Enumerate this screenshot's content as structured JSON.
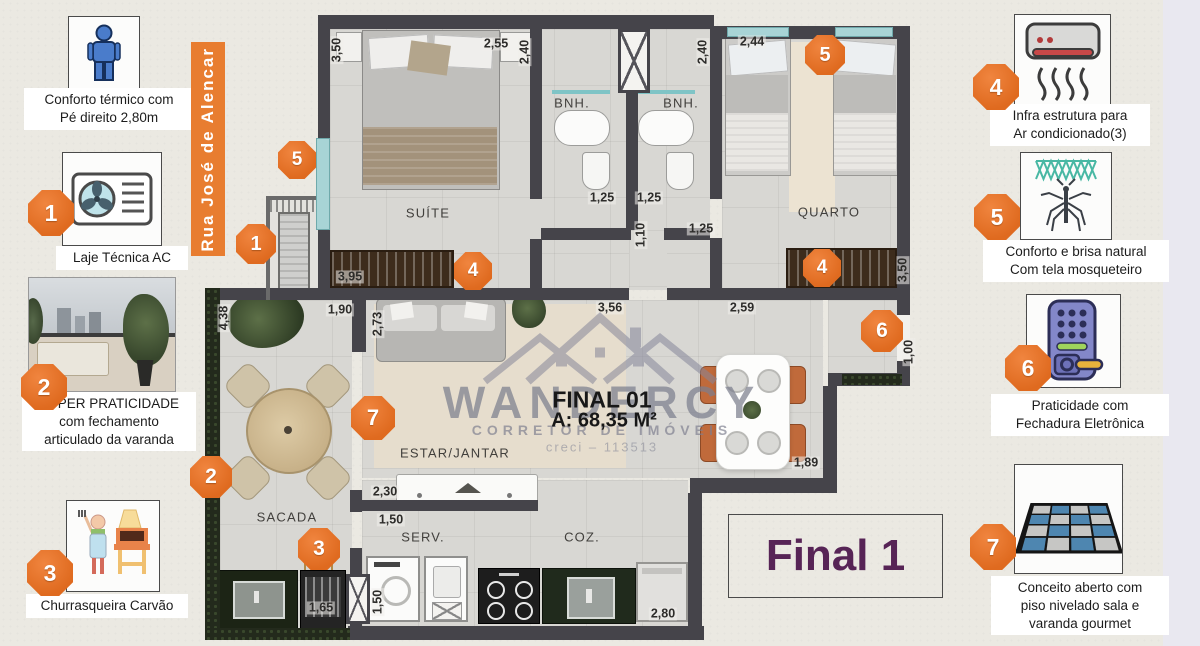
{
  "colors": {
    "accent_orange": "#e7702c",
    "banner_orange": "#e87d30",
    "final_purple": "#572456",
    "wall": "#45444a",
    "watermark_gray": "#8e90a0",
    "window_teal": "#a8d4d6"
  },
  "street_banner": {
    "label": "Rua José de Alencar"
  },
  "annotations": {
    "left": [
      {
        "icon": "person-icon",
        "text": "Conforto térmico com\nPé direito 2,80m"
      },
      {
        "badge": "1",
        "icon": "ac-fan-icon",
        "text": "Laje Técnica AC"
      },
      {
        "badge": "2",
        "icon": "balcony-photo",
        "text": "SUPER PRATICIDADE\ncom fechamento\narticulado  da varanda"
      },
      {
        "badge": "3",
        "icon": "bbq-icon",
        "text": "Churrasqueira Carvão"
      }
    ],
    "right": [
      {
        "badge": "4",
        "icon": "ac-wall-unit-icon",
        "text": "Infra estrutura para\nAr condicionado(3)"
      },
      {
        "badge": "5",
        "icon": "mosquito-net-icon",
        "text": "Conforto e brisa natural\nCom tela mosqueteiro"
      },
      {
        "badge": "6",
        "icon": "electronic-lock-icon",
        "text": "Praticidade  com\nFechadura Eletrônica"
      },
      {
        "badge": "7",
        "icon": "tiled-floor-icon",
        "text": "Conceito aberto com\npiso nivelado sala e\nvaranda gourmet"
      }
    ]
  },
  "plan": {
    "rooms": {
      "suite": "SUÍTE",
      "bnh_left": "BNH.",
      "bnh_right": "BNH.",
      "quarto": "QUARTO",
      "estar": "ESTAR/JANTAR",
      "sacada": "SACADA",
      "serv": "SERV.",
      "coz": "COZ."
    },
    "dims": {
      "suite_left": "3,50",
      "suite_top": "2,55",
      "bnh_wall": "2,40",
      "quarto_wall": "2,40",
      "quarto_top": "2,44",
      "bnh1": "1,25",
      "bnh2": "1,25",
      "hall": "1,10",
      "quarto_door": "1,25",
      "suite_wardrobe": "3,95",
      "quarto_wardrobe": "3,50",
      "sacada_top": "1,90",
      "estar_jog": "2,73",
      "estar_width": "3,56",
      "coz_top": "2,59",
      "sacada_height": "4,38",
      "entry_door": "1,00",
      "bancada": "2,30",
      "serv_door": "1,50",
      "dining": "1,89",
      "serv_height": "1,50",
      "churrasqueira": "1,65",
      "coz_width": "2,80"
    },
    "badges": {
      "suite_window": "5",
      "laje_tecnica": "1",
      "suite_wardrobe": "4",
      "quarto_window": "5",
      "quarto_wardrobe": "4",
      "entry_door": "6",
      "estar": "7",
      "sacada": "2",
      "churrasqueira": "3"
    },
    "unit": {
      "final_label": "FINAL 01",
      "area_label": "A: 68,35 M²",
      "final_box": "Final 1"
    }
  },
  "watermark": {
    "brand": "WANDERCY",
    "subtitle": "CORRETOR DE IMÓVEIS",
    "creci": "creci – 113513"
  }
}
